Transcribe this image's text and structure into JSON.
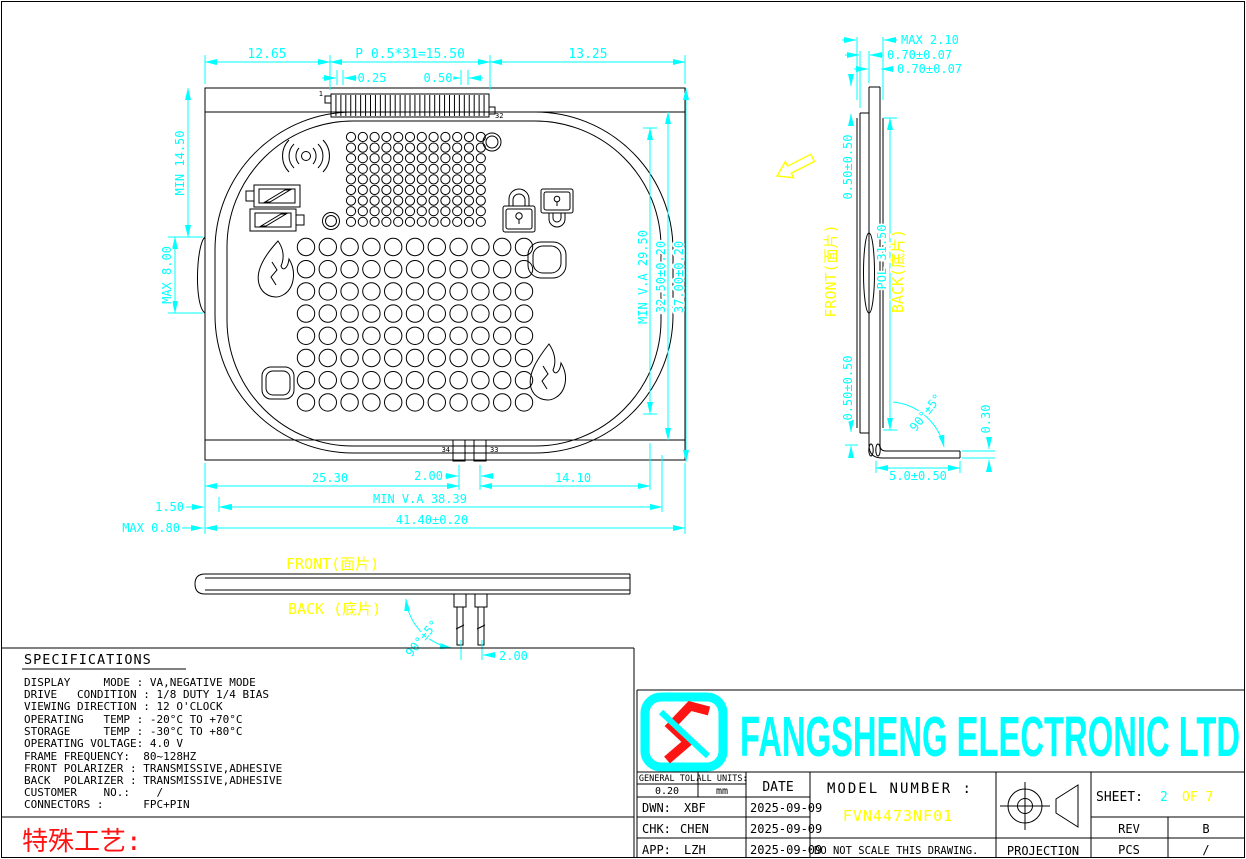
{
  "drawing": {
    "front_view": {
      "pin_first": "1",
      "pin_last": "32",
      "pin_34": "34",
      "pin_33": "33",
      "dim_top_left": "12.65",
      "dim_top_pitch": "P 0.5*31=15.50",
      "dim_top_right": "13.25",
      "dim_pin_offset": "0.25",
      "dim_pin_width": "0.50",
      "dim_min_1450": "MIN 14.50",
      "dim_max_800": "MAX 8.00",
      "dim_va_height": "MIN V.A 29.50",
      "dim_glass_height": "32.50±0.20",
      "dim_total_height": "37.00±0.20",
      "dim_2530": "25.30",
      "dim_200": "2.00",
      "dim_1410": "14.10",
      "dim_va_width": "MIN V.A 38.39",
      "dim_total_width": "41.40±0.20",
      "dim_150": "1.50",
      "dim_max_080": "MAX 0.80",
      "segments": {
        "connector_pins": 32,
        "small_grid": {
          "cols": 12,
          "rows": 9
        },
        "large_grid": {
          "cols": 11,
          "rows": 8
        }
      }
    },
    "side_view": {
      "dim_max_thickness": "MAX 2.10",
      "dim_glass_front": "0.70±0.07",
      "dim_glass_back": "0.70±0.07",
      "dim_offset_top": "0.50±0.50",
      "label_front": "FRONT(面片)",
      "dim_pol": "POL 31.50",
      "label_back": "BACK(底片)",
      "dim_offset_bottom": "0.50±0.50",
      "dim_bend_angle": "90°±5°",
      "dim_foot_thickness": "0.30",
      "dim_foot_length": "5.0±0.50"
    },
    "bottom_view": {
      "label_front": "FRONT(面片)",
      "label_back": "BACK (底片)",
      "dim_bend_angle": "90°±5°",
      "dim_pin_pitch": "2.00"
    }
  },
  "specifications": {
    "title": "SPECIFICATIONS",
    "lines": [
      "DISPLAY     MODE : VA,NEGATIVE MODE",
      "DRIVE   CONDITION : 1/8 DUTY 1/4 BIAS",
      "VIEWING DIRECTION : 12 O'CLOCK",
      "OPERATING   TEMP : -20°C TO +70°C",
      "STORAGE     TEMP : -30°C TO +80°C",
      "OPERATING VOLTAGE: 4.0 V",
      "FRAME FREQUENCY:  80~128HZ",
      "FRONT POLARIZER : TRANSMISSIVE,ADHESIVE",
      "BACK  POLARIZER : TRANSMISSIVE,ADHESIVE",
      "CUSTOMER    NO.:    /",
      "CONNECTORS :      FPC+PIN"
    ],
    "special_process": "特殊工艺:"
  },
  "title_block": {
    "company": "FANGSHENG ELECTRONIC LTD",
    "general_tol_label": "GENERAL TOL",
    "general_tol_value": "0.20",
    "units_label": "ALL UNITS:",
    "units_value": "mm",
    "date_label": "DATE",
    "model_label": "MODEL NUMBER :",
    "model_value": "FVN4473NF01",
    "rows": [
      {
        "role": "DWN:",
        "name": "XBF",
        "date": "2025-09-09"
      },
      {
        "role": "CHK:",
        "name": "CHEN",
        "date": "2025-09-09"
      },
      {
        "role": "APP:",
        "name": "LZH",
        "date": "2025-09-09"
      }
    ],
    "warning": "DO NOT SCALE THIS DRAWING.",
    "projection_label": "PROJECTION",
    "sheet_label": "SHEET:",
    "sheet_number": "2",
    "sheet_of": "OF 7",
    "rev_label": "REV",
    "rev_value": "B",
    "pcs_label": "PCS",
    "pcs_value": "/"
  },
  "colors": {
    "dimension": "#00ffff",
    "highlight": "#ffff00",
    "warning": "#ff1414",
    "line": "#000000",
    "background": "#ffffff"
  }
}
